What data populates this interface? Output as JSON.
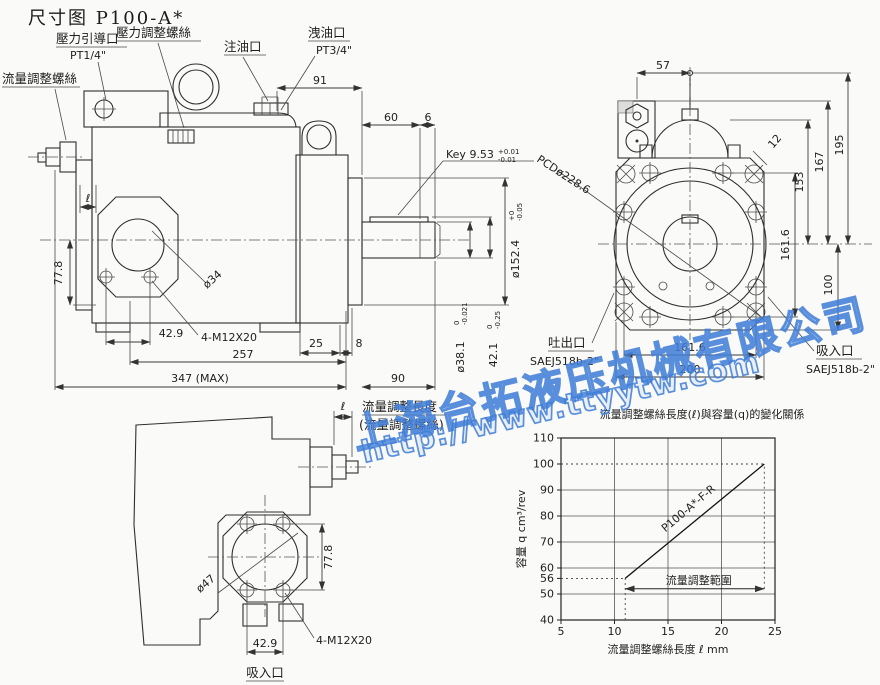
{
  "page": {
    "title": "尺寸图 P100-A*"
  },
  "watermark": {
    "company": "上海台拓液压机械有限公司",
    "url": "http://www.ttyytw.com",
    "color": "#3e7dd6"
  },
  "front_view": {
    "flow_screw_label": "流量調整螺絲",
    "pilot_port_label": "壓力引導口",
    "pilot_port_size": "PT1/4\"",
    "pressure_screw_label": "壓力調整螺絲",
    "oil_fill_label": "注油口",
    "drain_label": "洩油口",
    "drain_size": "PT3/4\"",
    "key_label": "Key 9.53",
    "key_tol_upper": "+0.01",
    "key_tol_lower": "-0.01",
    "ell": "ℓ",
    "d91": "91",
    "d60": "60",
    "d6": "6",
    "pilot_dia": "ø152.4",
    "pilot_tol_upper": "+0",
    "pilot_tol_lower": "-0.05",
    "d77_8": "77.8",
    "d34": "ø34",
    "d42_9": "42.9",
    "bolts": "4-M12X20",
    "d257": "257",
    "d25": "25",
    "d8": "8",
    "d347": "347 (MAX)",
    "d90": "90",
    "shaft_dia": "ø38.1",
    "shaft_tol_upper": "0",
    "shaft_tol_lower": "-0.021",
    "d42_1": "42.1",
    "d42_1_tol_upper": "0",
    "d42_1_tol_lower": "-0.25"
  },
  "end_view": {
    "d57": "57",
    "d195": "195",
    "d167": "167",
    "d153": "153",
    "d161_6_v": "161.6",
    "d100": "100",
    "d161_6_h": "161.6",
    "d200": "200",
    "d12": "12",
    "pcd": "PCDø228.6",
    "outlet_label": "吐出口",
    "outlet_size": "SAEJ518b-2\"",
    "inlet_label": "吸入口",
    "inlet_size": "SAEJ518b-2\""
  },
  "bottom_view": {
    "ell": "ℓ",
    "adjust_len_label": "流量調整長度",
    "adjust_screw_label": "(流量調整螺絲)",
    "d47": "ø47",
    "d77_8": "77.8",
    "d42_9": "42.9",
    "bolts": "4-M12X20",
    "inlet_label": "吸入口"
  },
  "chart_data": {
    "type": "line",
    "title": "流量調整螺絲長度(ℓ)與容量(q)的變化關係",
    "xlabel": "流量調整螺絲長度 ℓ mm",
    "ylabel": "容量 q cm³/rev",
    "xlim": [
      5,
      25
    ],
    "ylim": [
      40,
      110
    ],
    "xticks": [
      5,
      10,
      15,
      20,
      25
    ],
    "yticks": [
      40,
      50,
      56,
      60,
      70,
      80,
      90,
      100,
      110
    ],
    "xgrid": [
      10,
      15,
      20
    ],
    "ygrid": [
      50,
      60,
      70,
      80,
      90
    ],
    "grid": true,
    "legend_position": "on-line",
    "series": [
      {
        "name": "P100-A*-F-R",
        "points": [
          [
            11,
            56
          ],
          [
            24,
            100
          ]
        ]
      }
    ],
    "dashed_refs": [
      {
        "dir": "h",
        "y": 100,
        "x0": 5,
        "x1": 24
      },
      {
        "dir": "h",
        "y": 56,
        "x0": 5,
        "x1": 11
      },
      {
        "dir": "v",
        "x": 11,
        "y0": 40,
        "y1": 56
      },
      {
        "dir": "v",
        "x": 24,
        "y0": 52,
        "y1": 100
      }
    ],
    "range_annotation": {
      "label": "流量調整範圍",
      "x0": 11,
      "x1": 24,
      "y": 52
    }
  }
}
